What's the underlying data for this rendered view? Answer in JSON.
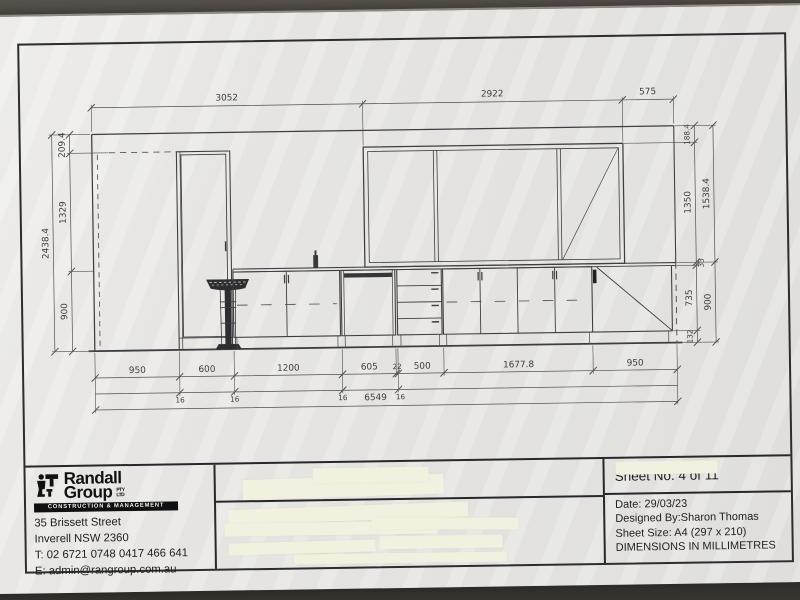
{
  "sheet": {
    "company": {
      "name_line1": "Randall",
      "name_line2": "Group",
      "suffix_line1": "PTY",
      "suffix_line2": "LTD",
      "tagline": "CONSTRUCTION & MANAGEMENT",
      "address_line1": "35 Brissett Street",
      "address_line2": "Inverell NSW 2360",
      "phone": "T: 02 6721 0748 0417 466 641",
      "email": "E: admin@rangroup.com.au"
    },
    "meta": {
      "sheet_no": "Sheet No. 4 of 11",
      "date": "Date: 29/03/23",
      "designed_by": "Designed By:Sharon Thomas",
      "sheet_size": "Sheet Size: A4 (297 x 210)",
      "units_note": "DIMENSIONS IN MILLIMETRES"
    }
  },
  "drawing": {
    "type": "kitchen-elevation",
    "dims": {
      "top": [
        "3052",
        "2922",
        "575"
      ],
      "left_outer": "2438.4",
      "left_inner": [
        "209.4",
        "1329",
        "900"
      ],
      "right_inner": [
        "188.4",
        "1350",
        "33",
        "735",
        "132"
      ],
      "right_outer": [
        "1538.4",
        "900"
      ],
      "bottom": [
        "950",
        "600",
        "1200",
        "605",
        "22",
        "500",
        "1677.8",
        "950"
      ],
      "gaps": [
        "16",
        "16",
        "16",
        "16"
      ],
      "total": "6549"
    }
  }
}
